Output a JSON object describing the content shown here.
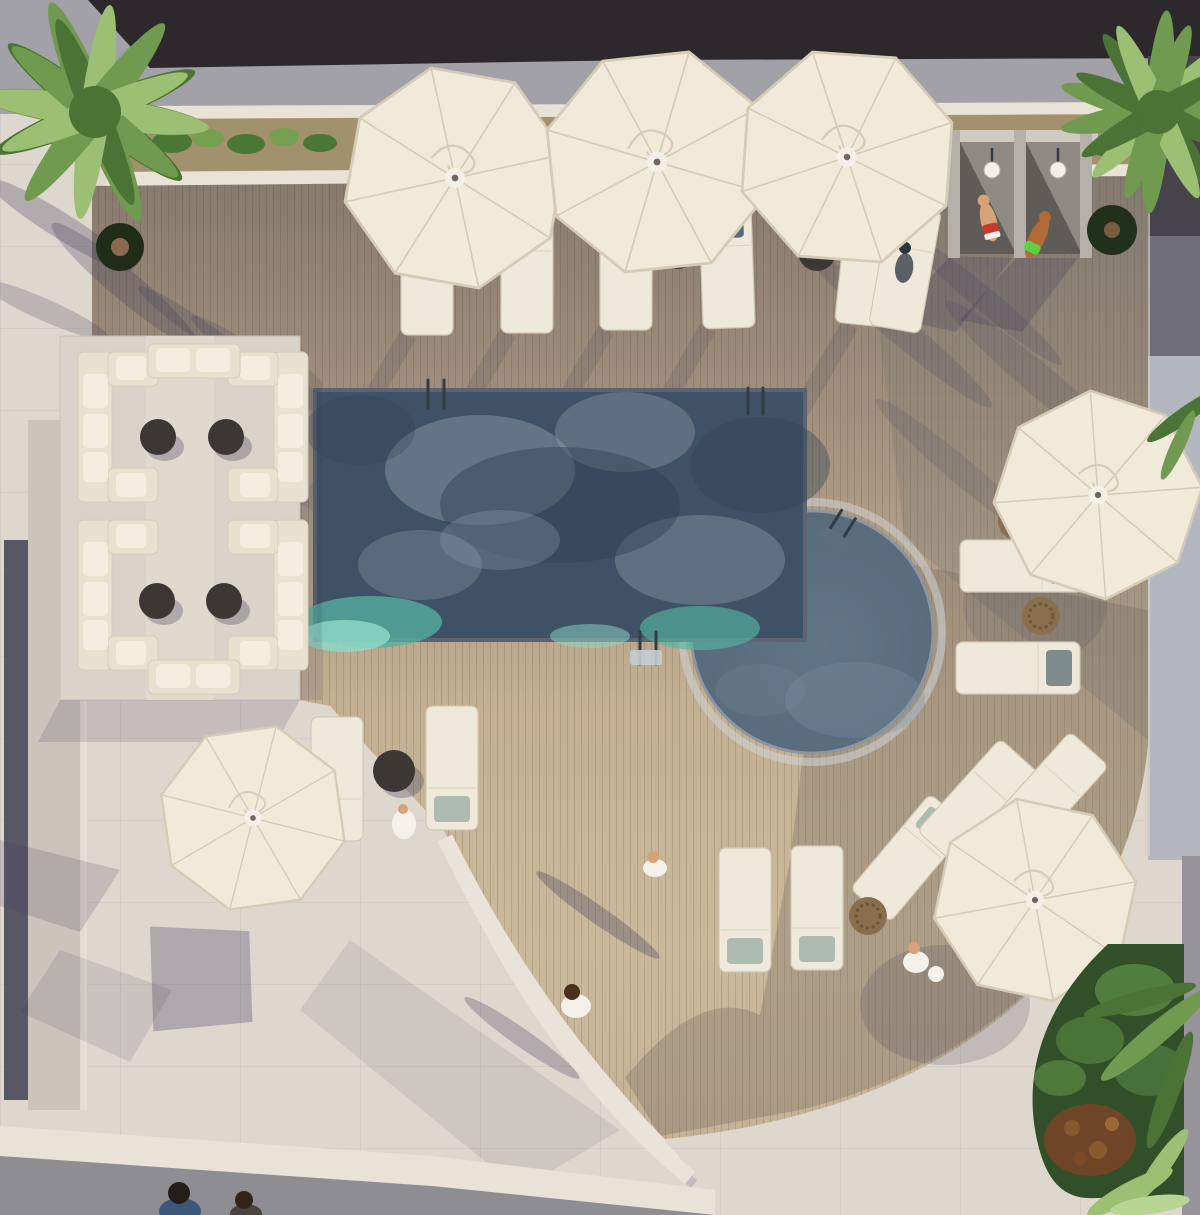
{
  "meta": {
    "title": "Resort pool terrace — aerial 3D rendering",
    "description": "Top-down architectural rendering of a resort pool deck: a rectangular pool with cloud reflections joined to a round plunge pool, cream patio umbrellas, white sun loungers with cushions, a four-cluster lounge sofa area with dark coffee tables, two open-air shower stalls with bathers, curved stone steps, palm trees and a planted garden corner."
  },
  "scene": {
    "setting": "aerial view of a resort pool terrace",
    "pools": [
      {
        "name": "main-pool",
        "shape": "rectangular",
        "water": "deep slate blue with cloud reflections and teal shallows"
      },
      {
        "name": "plunge-pool",
        "shape": "circular",
        "water": "slate gray-blue"
      }
    ],
    "umbrella_count": 6,
    "sun_lounger_count": 15,
    "sofa_cluster_count": 4,
    "coffee_table_count": 8,
    "pouf_count": 3,
    "shower_stall_count": 2,
    "people_count": 9,
    "palm_tree_count": 3,
    "curved_step_count": 3,
    "materials": [
      "wood plank decking",
      "light stone pavers",
      "concrete walkway",
      "dark roof slab"
    ]
  },
  "colors": {
    "pav": "#ded7ce",
    "bldg": "#2c282b",
    "walk": "#a2a1a7",
    "ledge": "#e8e2d7",
    "soil": "#a2916d",
    "plant": "#4a7636",
    "plant-light": "#74a050",
    "palm": "#6f9a4f",
    "palm-light": "#9cc073",
    "palm-dark": "#4b7336",
    "pool-deep": "#3f5166",
    "cloud": "#93a0ae",
    "cloud-dark": "#2e4155",
    "teal": "#55b3a2",
    "teal-light": "#8fd9c8",
    "roundpool": "#5d7181",
    "roundpool-light": "#7e93a2",
    "umbrella": "#f1eadb",
    "umbrella-seam": "#d6cbb6",
    "lounger": "#efe9dc",
    "lounger-edge": "#d2c8b4",
    "pillow-slate": "#5a6a7d",
    "pillow-sage": "#aebbb0",
    "pillow-gray": "#7e8b8d",
    "sofa": "#e9e1d0",
    "sofa-light": "#f5eee0",
    "sofa-edge": "#d6cdba",
    "platform": "#d9d3c9",
    "table-dark": "#3b3734",
    "pouf": "#8a6f4e",
    "shadow": "#3c3a5a",
    "stall-wall": "#b5b0a8",
    "stall-back": "#cfcac2",
    "stall-dark": "#5f5b57",
    "fixture": "#f2efe9",
    "garden": "#31502a",
    "garden-blob": "#5b8a42",
    "garden-red": "#6e4526",
    "walk-dark": "#8e8d92",
    "wall-light": "#cac4bb",
    "wall-dark": "#4a4a5c",
    "right-strip": "#b4b6c0",
    "right-strip-dark": "#46434b",
    "coping": "#667180",
    "ring": "#d0d4d7",
    "steel": "#343b43",
    "step": "#eae3d9",
    "skin": "#d8a278",
    "skin-dark": "#b26a36",
    "red": "#c83a30",
    "green": "#5ad43e",
    "hair-dark": "#241d18",
    "hair-brown": "#4a2f1d",
    "shirt-blue": "#3c567a",
    "white": "#f4f1ea"
  }
}
